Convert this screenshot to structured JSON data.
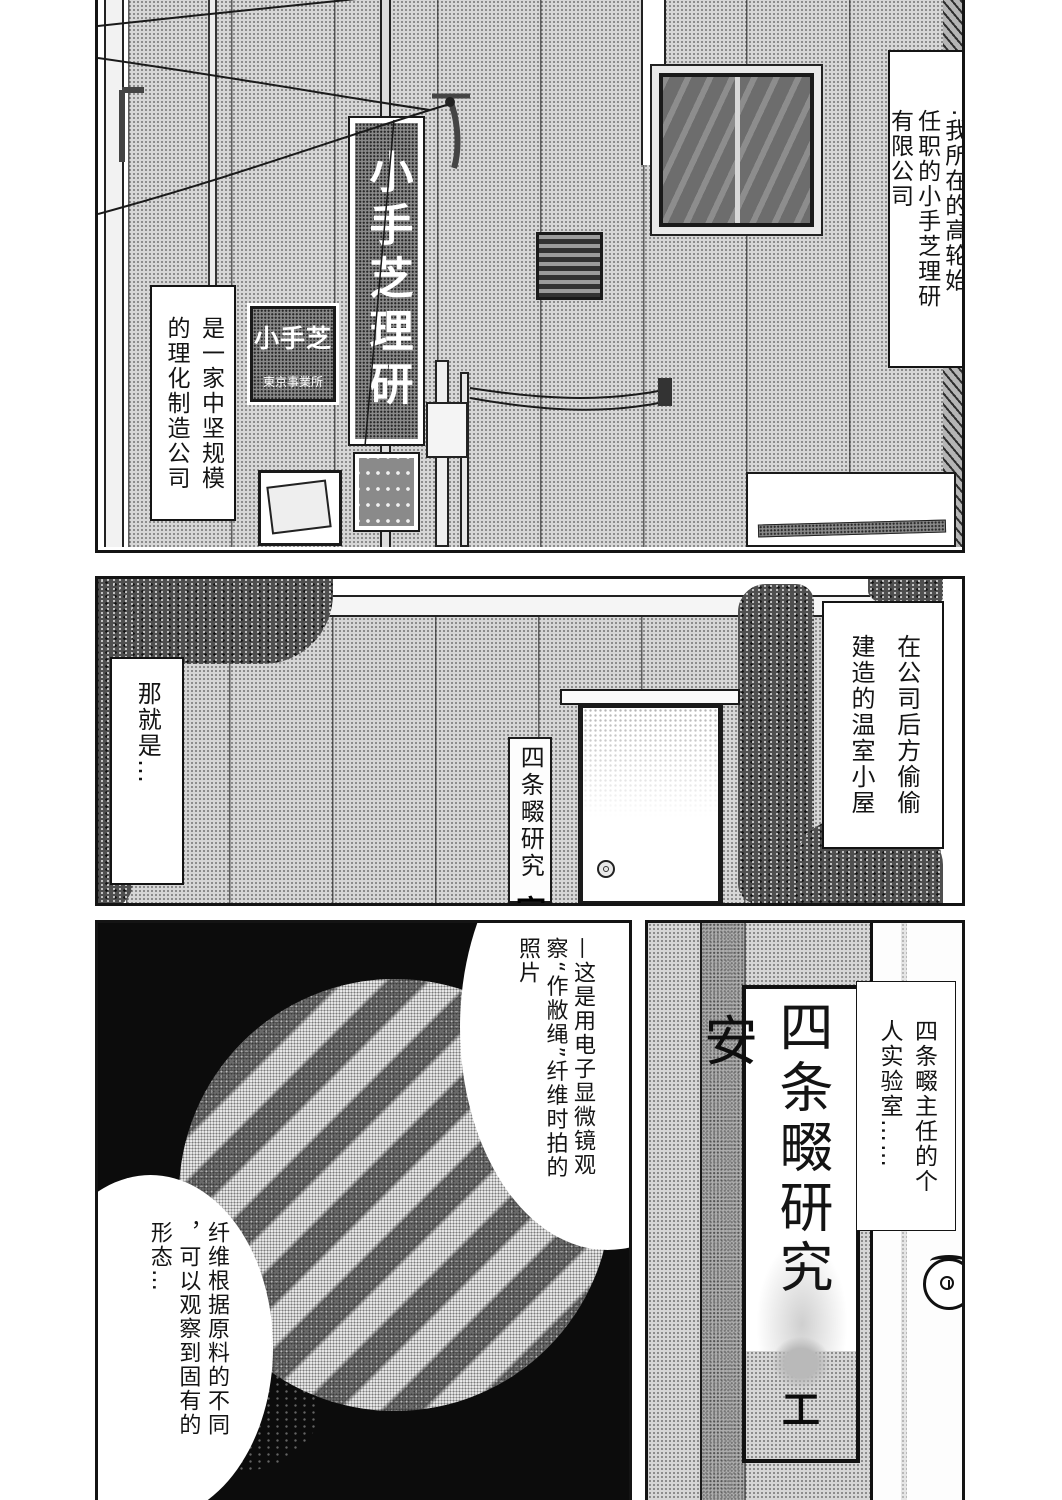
{
  "colors": {
    "ink": "#141414",
    "paper": "#ffffff",
    "halftone": "#d6d6d6"
  },
  "panel1": {
    "caption_right": "·我所在的高轮始\n任职的小手芝理研\n有限公司",
    "caption_left": "是一家中坚规模\n的理化制造公司",
    "pole_sign": "小手芝理研",
    "wall_sign_main": "小手芝",
    "wall_sign_sub": "東京事業所"
  },
  "panel2": {
    "caption_right": "在公司后方偷偷\n建造的温室小屋",
    "caption_left": "那就是…",
    "door_sign": "四条畷研究",
    "door_sign_partial": "室"
  },
  "panel3": {
    "bubble_top": "—这是用电子显微镜观\n察“作敝绳”纤维时拍的\n照片",
    "bubble_bottom": "纤维根据原料的不同\n，可以观察到固有的\n形态…"
  },
  "panel4": {
    "caption": "四条畷主任的个\n人实验室……",
    "door_sign": "四条畷研究",
    "door_sign_bottom": "工",
    "wall_char": "安"
  }
}
